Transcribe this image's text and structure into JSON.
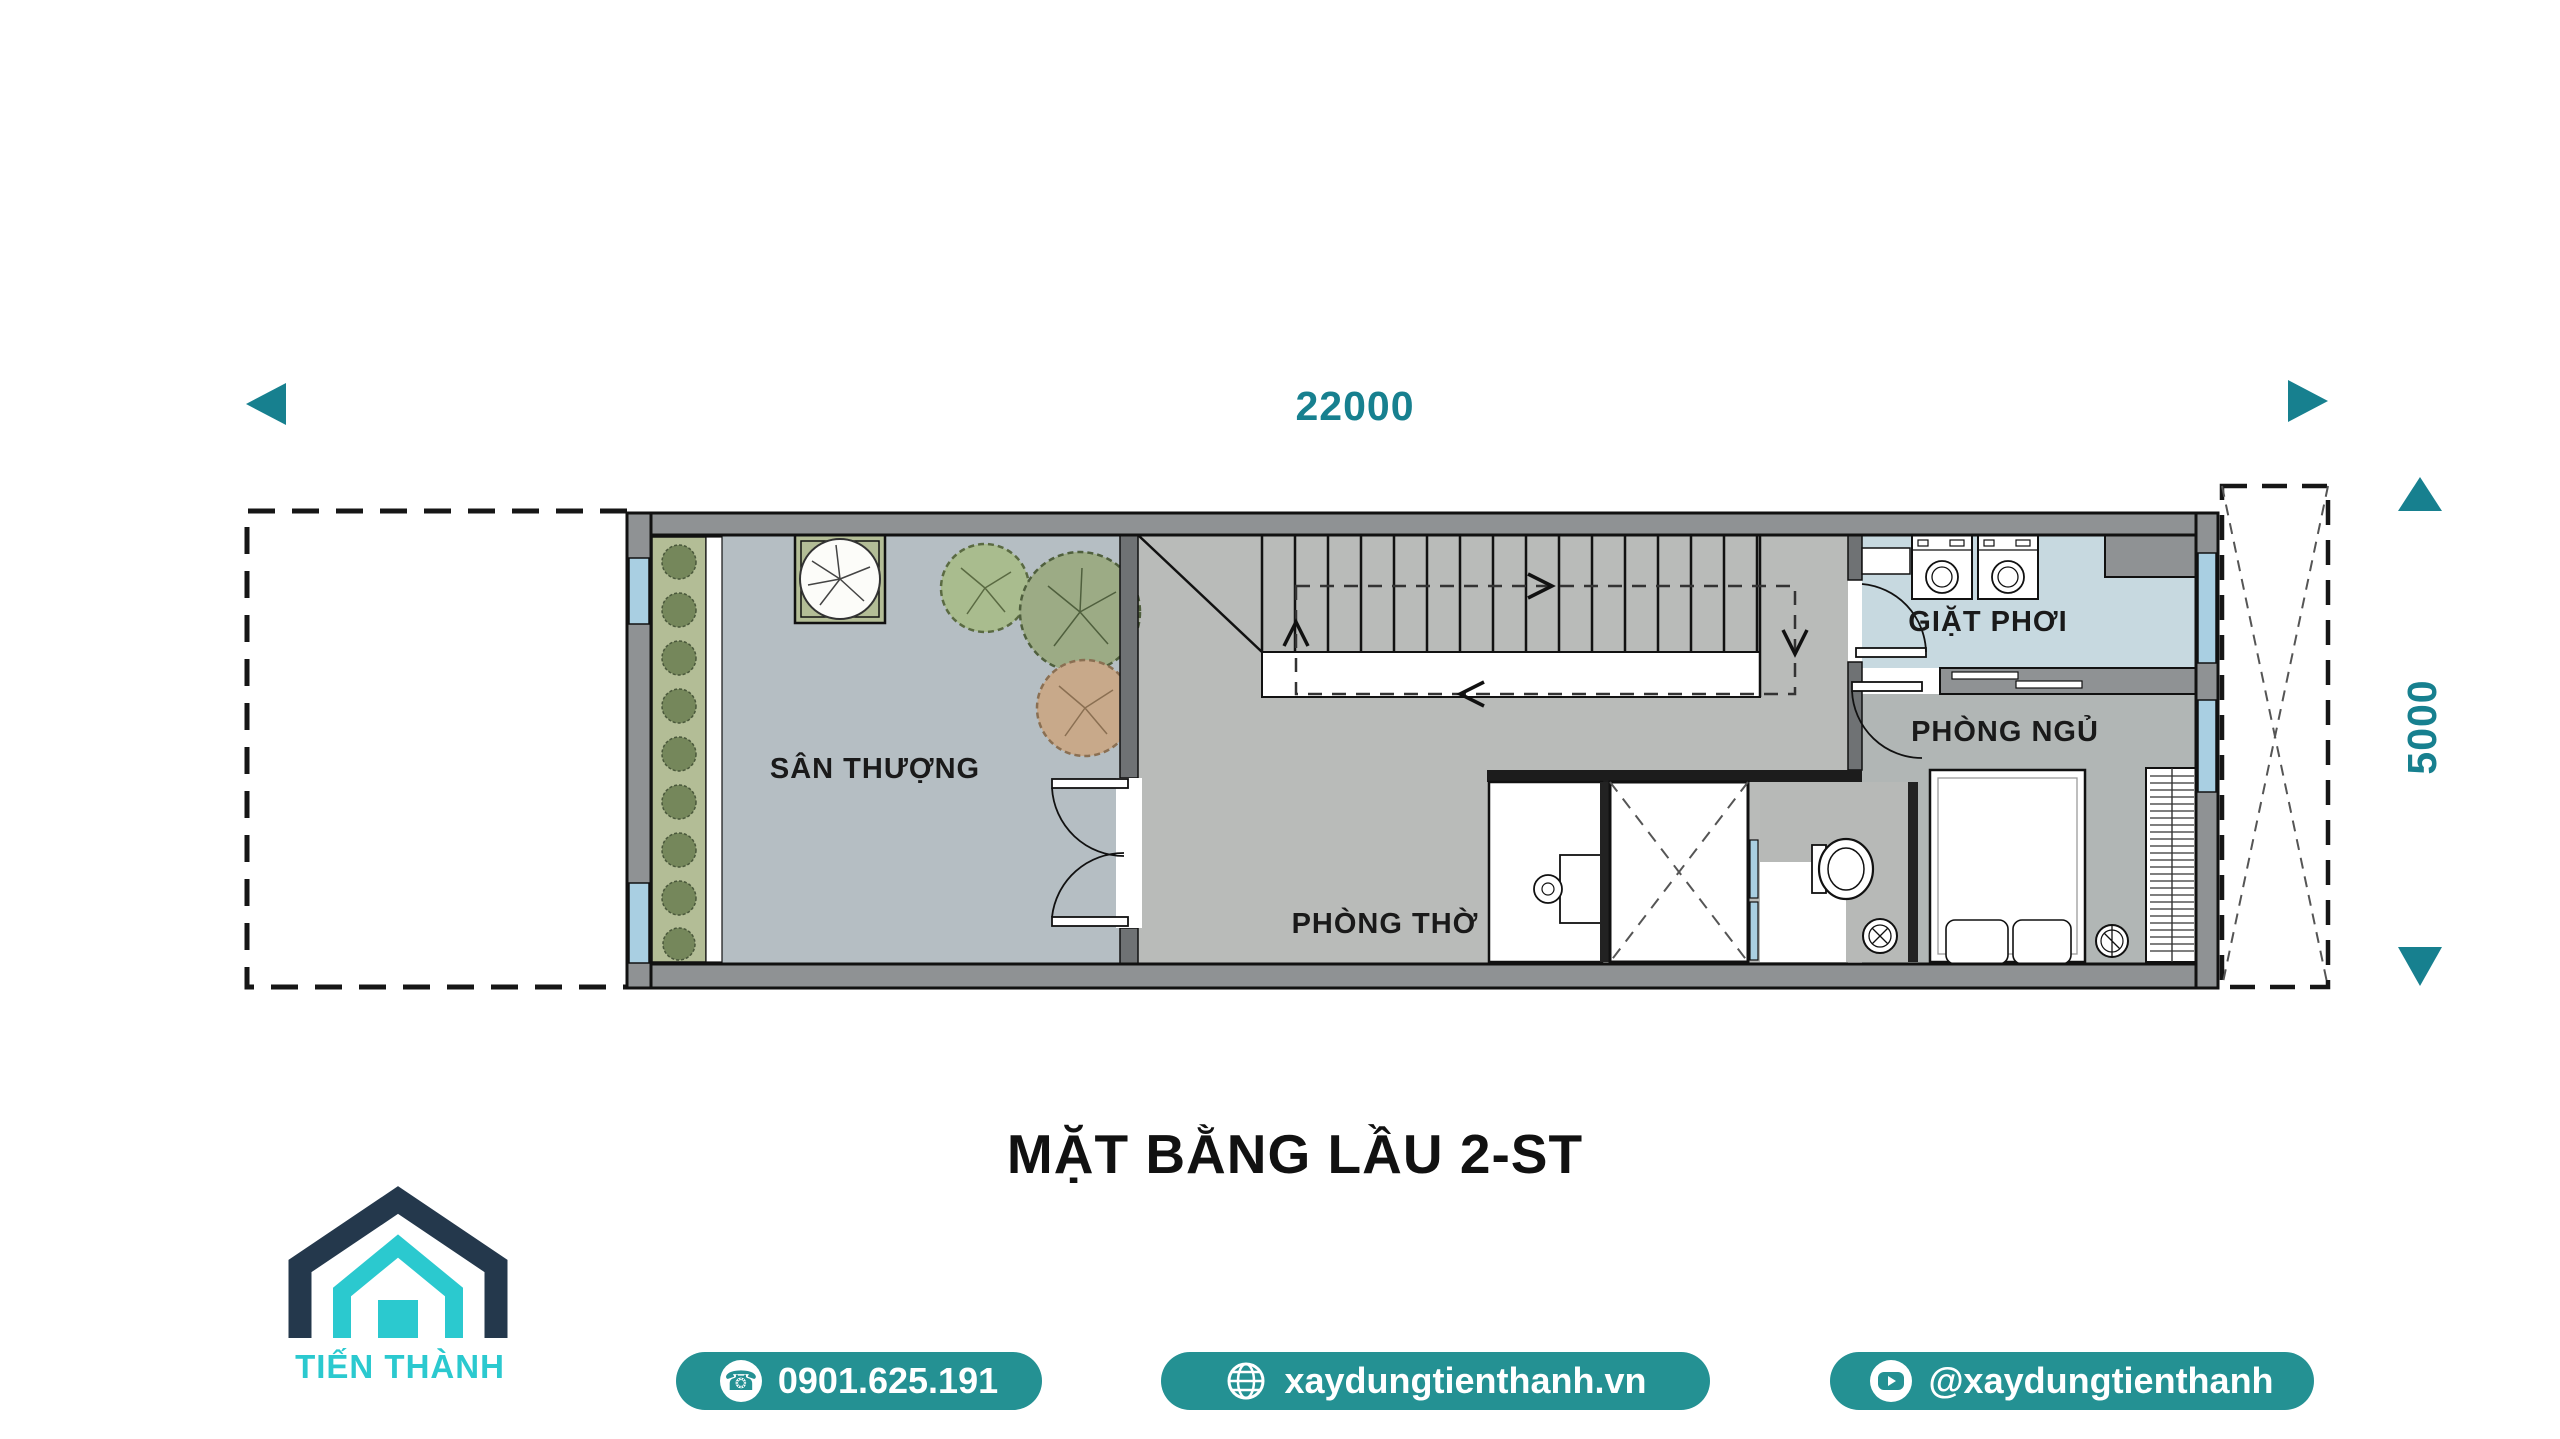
{
  "dimension_annotations": {
    "accent_color": "#17808f",
    "horizontal": {
      "label": "22000"
    },
    "vertical": {
      "label": "5000"
    }
  },
  "floor_plan": {
    "title": "MẶT BẰNG LẦU 2-ST",
    "rooms": [
      {
        "name": "terrace",
        "label": "SÂN THƯỢNG"
      },
      {
        "name": "worship-room",
        "label": "PHÒNG THỜ"
      },
      {
        "name": "laundry",
        "label": "GIẶT PHƠI"
      },
      {
        "name": "bedroom",
        "label": "PHÒNG NGỦ"
      }
    ],
    "features": [
      "staircase",
      "void-shaft",
      "double-door",
      "washing-machines",
      "bed",
      "wardrobe",
      "toilet",
      "planter-strip",
      "trees"
    ],
    "colors": {
      "terrace_floor": "#b5bec3",
      "hall_floor": "#b9bbb9",
      "laundry_floor": "#c7d9e0",
      "bedroom_floor": "#b1b6b5",
      "outer_wall": "#8f9294",
      "interior_wall": "#6f7274",
      "window": "#a9cfe2",
      "planter": "#b3bd96",
      "label_text": "#1a1a1a"
    }
  },
  "branding": {
    "company_name": "TIẾN THÀNH",
    "logo_colors": {
      "navy": "#24384c",
      "cyan": "#2bc9cf"
    },
    "badge_color": "#249193",
    "contacts": [
      {
        "icon": "phone-icon",
        "label": "0901.625.191"
      },
      {
        "icon": "globe-icon",
        "label": "xaydungtienthanh.vn"
      },
      {
        "icon": "youtube-icon",
        "label": "@xaydungtienthanh"
      }
    ]
  }
}
